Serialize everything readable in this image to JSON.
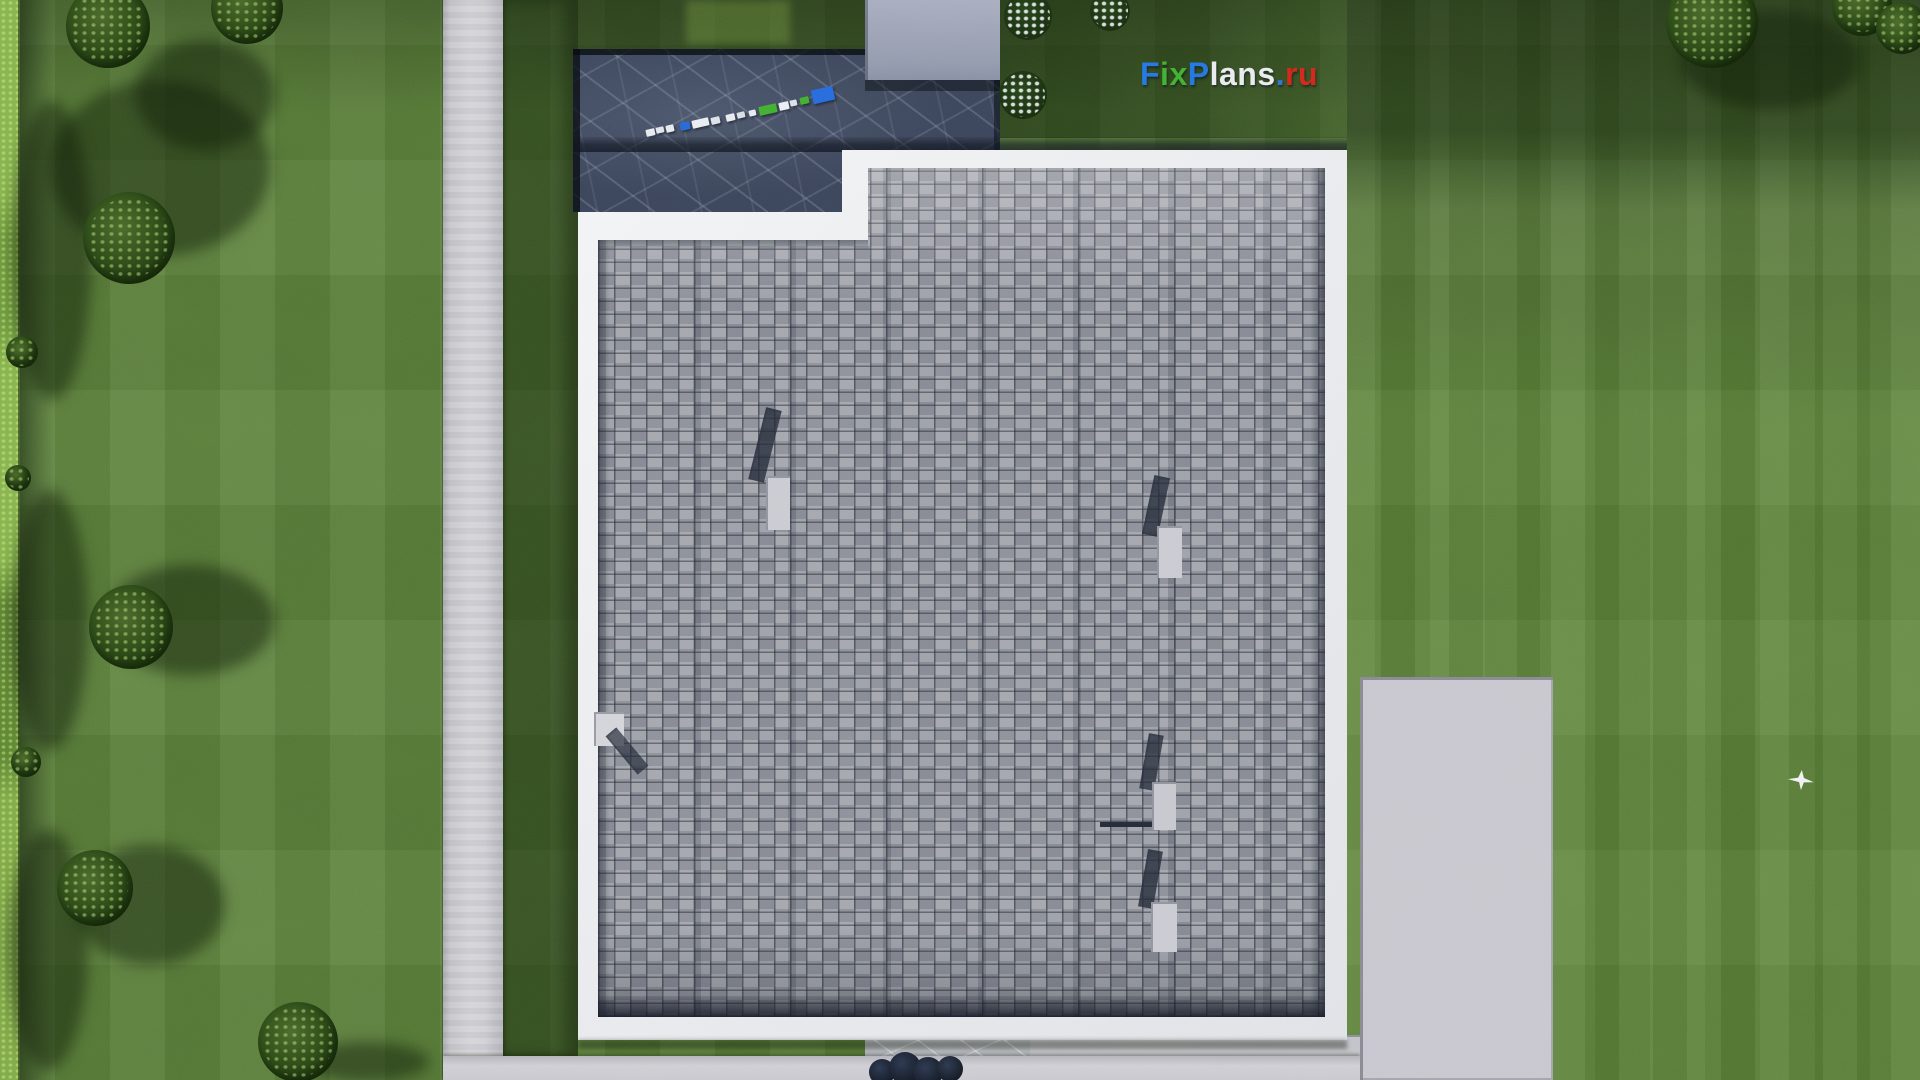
{
  "scene": {
    "type": "aerial-3d-render",
    "description": "Top-down 3D architectural render: flat shingle roof house with white parapet, dark stone terrace, concrete paths and pads on a green lawn with trees and hedges",
    "watermark": {
      "text": "FixPlans.ru",
      "segments": [
        {
          "name": "wm-F",
          "text": "F",
          "color": "#2273e0"
        },
        {
          "name": "wm-ix",
          "text": "ix",
          "color": "#3fae2e"
        },
        {
          "name": "wm-P",
          "text": "P",
          "color": "#2273e0"
        },
        {
          "name": "wm-lans",
          "text": "lans",
          "color": "#e9eaee"
        },
        {
          "name": "wm-dot",
          "text": ".",
          "color": "#2e6fd6"
        },
        {
          "name": "wm-ru",
          "text": "ru",
          "color": "#d02418"
        }
      ]
    },
    "palette": {
      "grass_base": "#597d39",
      "grass_shadow": "#2c421e",
      "hedge": "#86b24e",
      "concrete_path": "#cbcad1",
      "parapet_white": "#e9ebee",
      "shingle_gray": "#9598a2",
      "terrace_stone": "#39415a",
      "patio_pad": "#c7c5ce",
      "entry_pad": "#9aa0b6"
    }
  },
  "clothesline": {
    "items": [
      {
        "name": "laundry-white",
        "x": 646,
        "y": 129,
        "w": 9,
        "h": 7,
        "bg": "#e6e9ee"
      },
      {
        "name": "laundry-white",
        "x": 656,
        "y": 127,
        "w": 8,
        "h": 6,
        "bg": "#dfe3ea"
      },
      {
        "name": "laundry-white",
        "x": 666,
        "y": 125,
        "w": 8,
        "h": 7,
        "bg": "#e6e9ee"
      },
      {
        "name": "laundry-blue",
        "x": 680,
        "y": 122,
        "w": 10,
        "h": 8,
        "bg": "#2565d6"
      },
      {
        "name": "laundry-white",
        "x": 692,
        "y": 119,
        "w": 17,
        "h": 8,
        "bg": "#e9ecf1"
      },
      {
        "name": "laundry-white",
        "x": 711,
        "y": 117,
        "w": 9,
        "h": 7,
        "bg": "#dde1e8"
      },
      {
        "name": "laundry-white",
        "x": 726,
        "y": 114,
        "w": 9,
        "h": 7,
        "bg": "#e6e9ee"
      },
      {
        "name": "laundry-white",
        "x": 737,
        "y": 112,
        "w": 8,
        "h": 6,
        "bg": "#d8dce4"
      },
      {
        "name": "laundry-white",
        "x": 749,
        "y": 110,
        "w": 7,
        "h": 6,
        "bg": "#e6e9ee"
      },
      {
        "name": "laundry-green",
        "x": 759,
        "y": 105,
        "w": 18,
        "h": 9,
        "bg": "#3fae2e"
      },
      {
        "name": "laundry-white",
        "x": 779,
        "y": 102,
        "w": 10,
        "h": 8,
        "bg": "#e9ecf1"
      },
      {
        "name": "laundry-white",
        "x": 790,
        "y": 100,
        "w": 7,
        "h": 6,
        "bg": "#dde1e8"
      },
      {
        "name": "laundry-green",
        "x": 800,
        "y": 97,
        "w": 9,
        "h": 7,
        "bg": "#3fae2e"
      },
      {
        "name": "laundry-blue",
        "x": 812,
        "y": 88,
        "w": 22,
        "h": 14,
        "bg": "#2468dc"
      }
    ]
  },
  "roof_objects": [
    {
      "name": "chimney-shadow",
      "x": 757,
      "y": 408,
      "w": 16,
      "h": 74,
      "rot": 14,
      "bg": "rgba(32,36,54,0.78)"
    },
    {
      "name": "chimney-box",
      "x": 766,
      "y": 476,
      "w": 24,
      "h": 54,
      "rot": 0,
      "bg": "#c9cad2"
    },
    {
      "name": "chimney-shadow",
      "x": 1148,
      "y": 476,
      "w": 16,
      "h": 60,
      "rot": 12,
      "bg": "rgba(32,36,54,0.78)"
    },
    {
      "name": "chimney-box",
      "x": 1157,
      "y": 526,
      "w": 25,
      "h": 52,
      "rot": 0,
      "bg": "#c9cad2"
    },
    {
      "name": "vent-pipe-line",
      "x": 1100,
      "y": 822,
      "w": 74,
      "h": 5,
      "rot": 0,
      "bg": "#232736"
    },
    {
      "name": "vent-shadow",
      "x": 1144,
      "y": 734,
      "w": 15,
      "h": 56,
      "rot": 10,
      "bg": "rgba(32,36,54,0.75)"
    },
    {
      "name": "vent-box",
      "x": 1152,
      "y": 782,
      "w": 24,
      "h": 48,
      "rot": 0,
      "bg": "#c6c7cf"
    },
    {
      "name": "chimney-shadow",
      "x": 1143,
      "y": 850,
      "w": 15,
      "h": 58,
      "rot": 10,
      "bg": "rgba(32,36,54,0.78)"
    },
    {
      "name": "chimney-box",
      "x": 1151,
      "y": 902,
      "w": 26,
      "h": 50,
      "rot": 0,
      "bg": "#c9cad2"
    },
    {
      "name": "roof-hatch-box",
      "x": 594,
      "y": 712,
      "w": 30,
      "h": 34,
      "rot": 0,
      "bg": "#d2d3d9"
    },
    {
      "name": "hatch-shadow",
      "x": 620,
      "y": 726,
      "w": 14,
      "h": 50,
      "rot": -40,
      "bg": "rgba(32,36,54,0.7)"
    }
  ],
  "vegetation": {
    "trees": [
      {
        "name": "tree",
        "x": 108,
        "y": 26,
        "r": 42
      },
      {
        "name": "tree",
        "x": 247,
        "y": 8,
        "r": 36
      },
      {
        "name": "tree",
        "x": 129,
        "y": 238,
        "r": 46
      },
      {
        "name": "tree",
        "x": 131,
        "y": 627,
        "r": 42
      },
      {
        "name": "tree",
        "x": 95,
        "y": 888,
        "r": 38
      },
      {
        "name": "tree",
        "x": 298,
        "y": 1042,
        "r": 40
      },
      {
        "name": "tree",
        "x": 1712,
        "y": 22,
        "r": 46
      },
      {
        "name": "tree",
        "x": 1862,
        "y": 6,
        "r": 30
      },
      {
        "name": "tree",
        "x": 1902,
        "y": 28,
        "r": 26
      },
      {
        "name": "hedge-bush",
        "x": 22,
        "y": 352,
        "r": 16
      },
      {
        "name": "hedge-bush",
        "x": 18,
        "y": 478,
        "r": 13
      },
      {
        "name": "hedge-bush",
        "x": 26,
        "y": 762,
        "r": 15
      }
    ],
    "tree_shadows": [
      {
        "name": "tree-shadow",
        "x": 160,
        "y": 168,
        "rx": 110,
        "ry": 88
      },
      {
        "name": "tree-shadow",
        "x": 205,
        "y": 95,
        "rx": 70,
        "ry": 55
      },
      {
        "name": "tree-shadow",
        "x": 190,
        "y": 620,
        "rx": 85,
        "ry": 55
      },
      {
        "name": "tree-shadow",
        "x": 150,
        "y": 905,
        "rx": 75,
        "ry": 60
      },
      {
        "name": "tree-shadow",
        "x": 368,
        "y": 1062,
        "rx": 62,
        "ry": 20
      },
      {
        "name": "hedge-shadow-blob",
        "x": 52,
        "y": 250,
        "rx": 40,
        "ry": 150
      },
      {
        "name": "hedge-shadow-blob",
        "x": 50,
        "y": 620,
        "rx": 38,
        "ry": 130
      },
      {
        "name": "hedge-shadow-blob",
        "x": 48,
        "y": 950,
        "rx": 40,
        "ry": 120
      },
      {
        "name": "tree-shadow",
        "x": 1770,
        "y": 60,
        "rx": 90,
        "ry": 50
      }
    ],
    "flower_bushes": [
      {
        "name": "flowering-bush",
        "x": 1028,
        "y": 16,
        "r": 24
      },
      {
        "name": "flowering-bush",
        "x": 1110,
        "y": 11,
        "r": 20
      },
      {
        "name": "flowering-bush",
        "x": 1023,
        "y": 95,
        "r": 24
      }
    ],
    "dark_bushes": [
      {
        "name": "dark-bush",
        "x": 882,
        "y": 1072,
        "r": 13
      },
      {
        "name": "dark-bush",
        "x": 905,
        "y": 1068,
        "r": 16
      },
      {
        "name": "dark-bush",
        "x": 928,
        "y": 1072,
        "r": 15
      },
      {
        "name": "dark-bush",
        "x": 950,
        "y": 1069,
        "r": 13
      }
    ]
  },
  "birds": [
    {
      "name": "bird",
      "x": 1788,
      "y": 770,
      "w": 26,
      "h": 20
    }
  ]
}
